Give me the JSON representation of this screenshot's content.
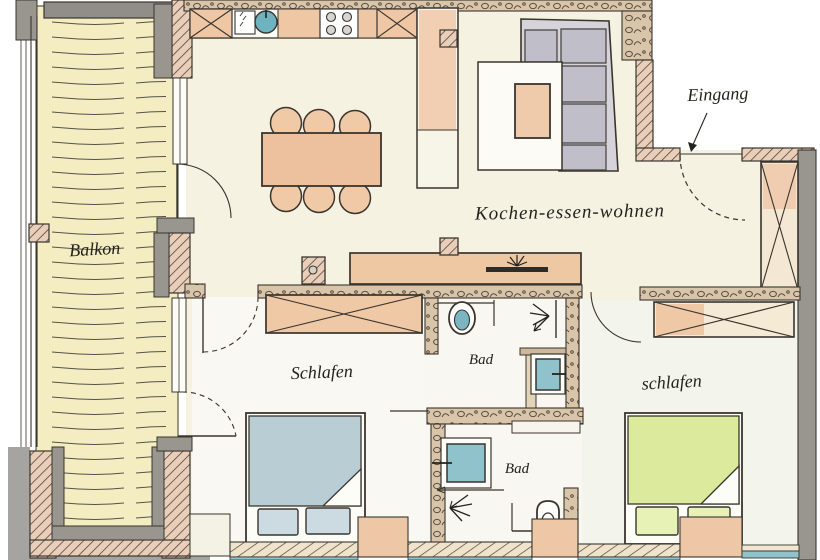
{
  "title": "Hand-drawn apartment floor plan",
  "labels": {
    "balcony": "Balkon",
    "living": "Kochen-essen-wohnen",
    "entrance": "Eingang",
    "bedroom_left": "Schlafen",
    "bedroom_right": "schlafen",
    "bath_top": "Bad",
    "bath_bottom": "Bad"
  },
  "furniture": {
    "kitchen": [
      "cabinet-x",
      "sink-unit",
      "counter",
      "stove-4-burners",
      "cabinet-x",
      "tall-cabinet"
    ],
    "living": [
      "corner-sofa",
      "rug",
      "coffee-table",
      "dining-table-6-chairs",
      "sideboard",
      "tv",
      "plant"
    ],
    "bedroom_left": [
      "wardrobe-x",
      "double-bed-blue"
    ],
    "bedroom_right": [
      "wardrobe-x",
      "double-bed-green"
    ],
    "bath_top": [
      "toilet",
      "shower",
      "washbasin"
    ],
    "bath_bottom": [
      "washbasin",
      "shower",
      "toilet"
    ],
    "entrance_hall": [
      "wardrobe-x"
    ]
  },
  "colors": {
    "wall_hatch": "#e9cfba",
    "wall_stone": "#d9c5a9",
    "wall_gray": "#98968f",
    "balcony_floor": "#f4edc2",
    "living_floor": "#f6f2e2",
    "accent_orange": "#efc8a6",
    "water_teal": "#8fc2cb",
    "bed_left_blue": "#b9cdd5",
    "bed_right_green": "#dcea9e",
    "sofa_gray": "#c0bec9",
    "ink": "#3a352e"
  }
}
